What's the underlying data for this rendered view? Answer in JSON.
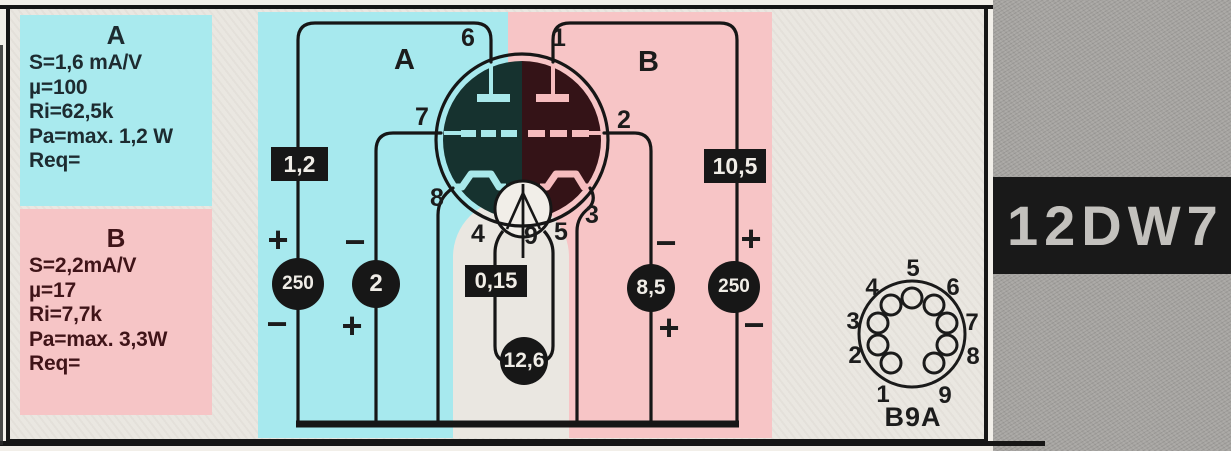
{
  "part": {
    "number": "12DW7",
    "base_type": "B9A"
  },
  "colors": {
    "section_a_highlight": "#a7e9ee",
    "section_b_highlight": "#f7c5c6",
    "badge_background": "#171717",
    "badge_text": "#f0ede7"
  },
  "specs": {
    "a": {
      "title": "A",
      "lines": [
        "S=1,6 mA/V",
        "µ=100",
        "Ri=62,5k",
        "Pa=max. 1,2 W",
        "Req="
      ]
    },
    "b": {
      "title": "B",
      "lines": [
        "S=2,2mA/V",
        "µ=17",
        "Ri=7,7k",
        "Pa=max. 3,3W",
        "Req="
      ]
    }
  },
  "circuit": {
    "section_a_label": "A",
    "section_b_label": "B",
    "pins": {
      "p1": "1",
      "p2": "2",
      "p3": "3",
      "p4": "4",
      "p5": "5",
      "p6": "6",
      "p7": "7",
      "p8": "8",
      "p9": "9"
    },
    "values": {
      "a_anode_rect": "1,2",
      "b_anode_rect": "10,5",
      "heater_rect": "0,15",
      "a_anode_circle": "250",
      "a_grid_circle": "2",
      "b_grid_circle": "8,5",
      "b_anode_circle": "250",
      "heater_circle": "12,6"
    },
    "signs": {
      "a_anode_top": "+",
      "a_anode_bottom": "−",
      "a_grid_top": "−",
      "a_grid_bottom": "+",
      "b_grid_top": "−",
      "b_grid_bottom": "+",
      "b_anode_top": "+",
      "b_anode_bottom": "−"
    }
  },
  "pinout": {
    "pins": [
      "1",
      "2",
      "3",
      "4",
      "5",
      "6",
      "7",
      "8",
      "9"
    ],
    "label": "B9A"
  }
}
